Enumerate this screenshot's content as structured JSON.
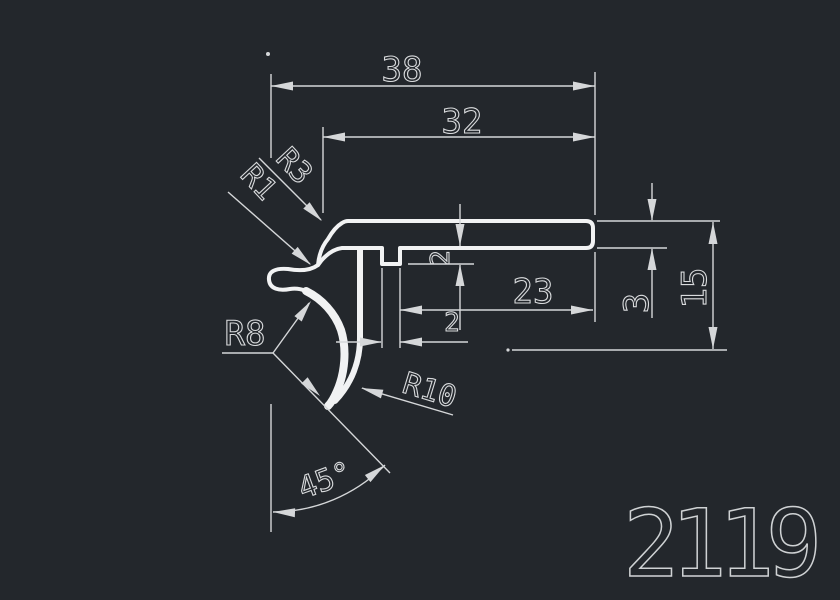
{
  "drawing": {
    "part_number": "2119"
  },
  "dims": {
    "overall_width": "38",
    "upper_width": "32",
    "right_width": "23",
    "rib_width": "2",
    "rib_depth": "2",
    "flange_thickness": "3",
    "overall_height": "15",
    "corner_radius": "R3",
    "notch_radius": "R1",
    "hook_inner_radius": "R8",
    "lip_outer_radius": "R10",
    "lip_angle": "45°"
  },
  "colors": {
    "background": "#23272c",
    "profile_line": "#f1f2f3",
    "dimension_line": "#d5d7d9"
  }
}
